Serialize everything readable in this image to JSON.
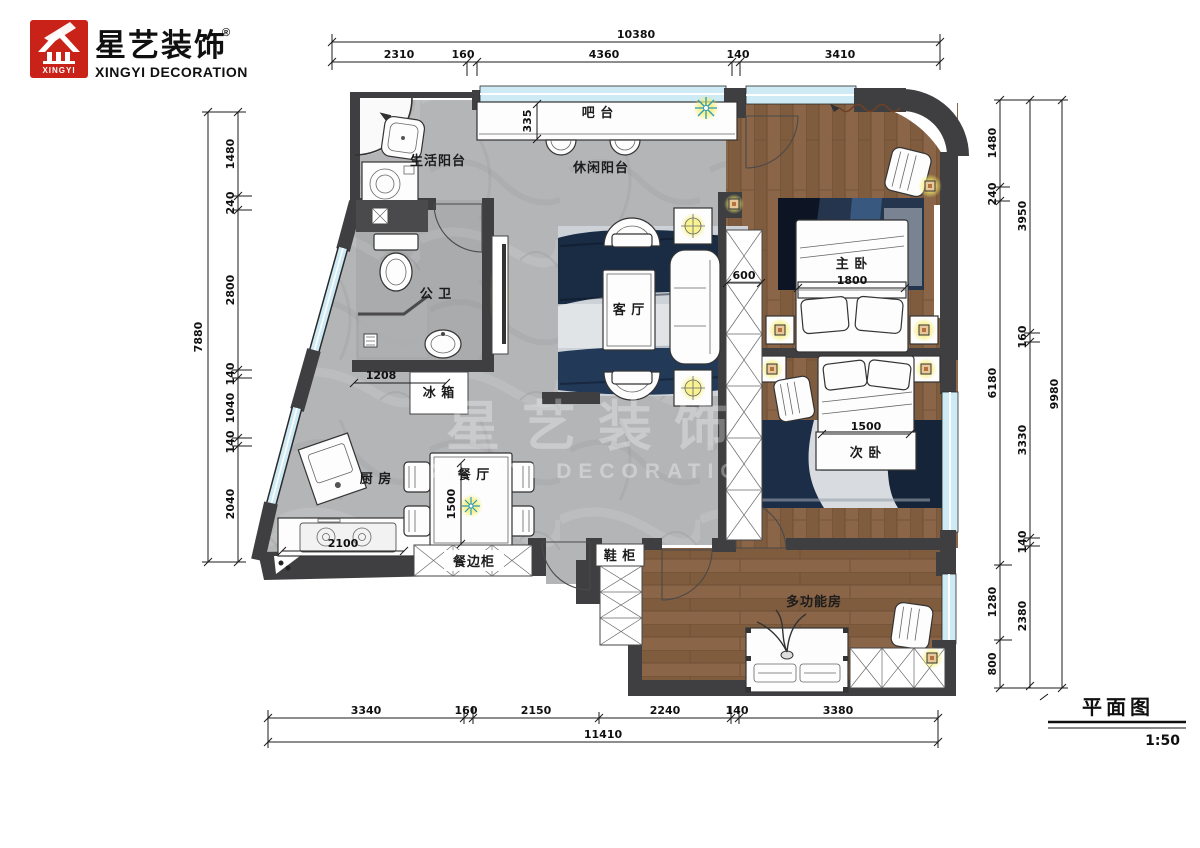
{
  "brand": {
    "name_cn": "星艺装饰",
    "reg": "®",
    "name_en": "XINGYI DECORATION",
    "logo_text": "XINGYI"
  },
  "titleblock": {
    "title": "平面图",
    "scale": "1:50"
  },
  "watermark": {
    "cn": "星艺装饰",
    "en": "XINGYI DECORATION"
  },
  "rooms": {
    "bar": "吧 台",
    "life_balcony": "生活阳台",
    "leisure_balcony": "休闲阳台",
    "master": "主 卧",
    "living": "客 厅",
    "bathroom": "公 卫",
    "fridge": "冰 箱",
    "kitchen": "厨 房",
    "dining": "餐 厅",
    "sideboard": "餐边柜",
    "shoe": "鞋 柜",
    "second": "次 卧",
    "multi": "多功能房"
  },
  "dims": {
    "top": {
      "total": "10380",
      "s": [
        "2310",
        "160",
        "4360",
        "140",
        "3410"
      ]
    },
    "bottom": {
      "total": "11410",
      "s": [
        "3340",
        "160",
        "2150",
        "2240",
        "140",
        "3380"
      ]
    },
    "left": {
      "total": "7880",
      "s": [
        "1480",
        "240",
        "2800",
        "140",
        "1040",
        "140",
        "2040"
      ]
    },
    "right": {
      "outer": "9980",
      "inner": [
        "1480",
        "240",
        "6180",
        "1280",
        "800"
      ],
      "middle": [
        "3950",
        "160",
        "3330",
        "140",
        "2380"
      ]
    },
    "inline": {
      "bar_depth": "335",
      "wardrobe": "600",
      "master_bed": "1800",
      "bathroom": "1208",
      "kitchen": "2100",
      "dining": "1500",
      "second_bed": "1500"
    }
  },
  "colors": {
    "wall": "#3f3f41",
    "window": "#cdeaf5",
    "wood": "#8a6547",
    "floor": "#b4b5b7",
    "glow": "#f6ee6a",
    "logo_red": "#c92219",
    "rug_navy": "#1a2b44"
  }
}
